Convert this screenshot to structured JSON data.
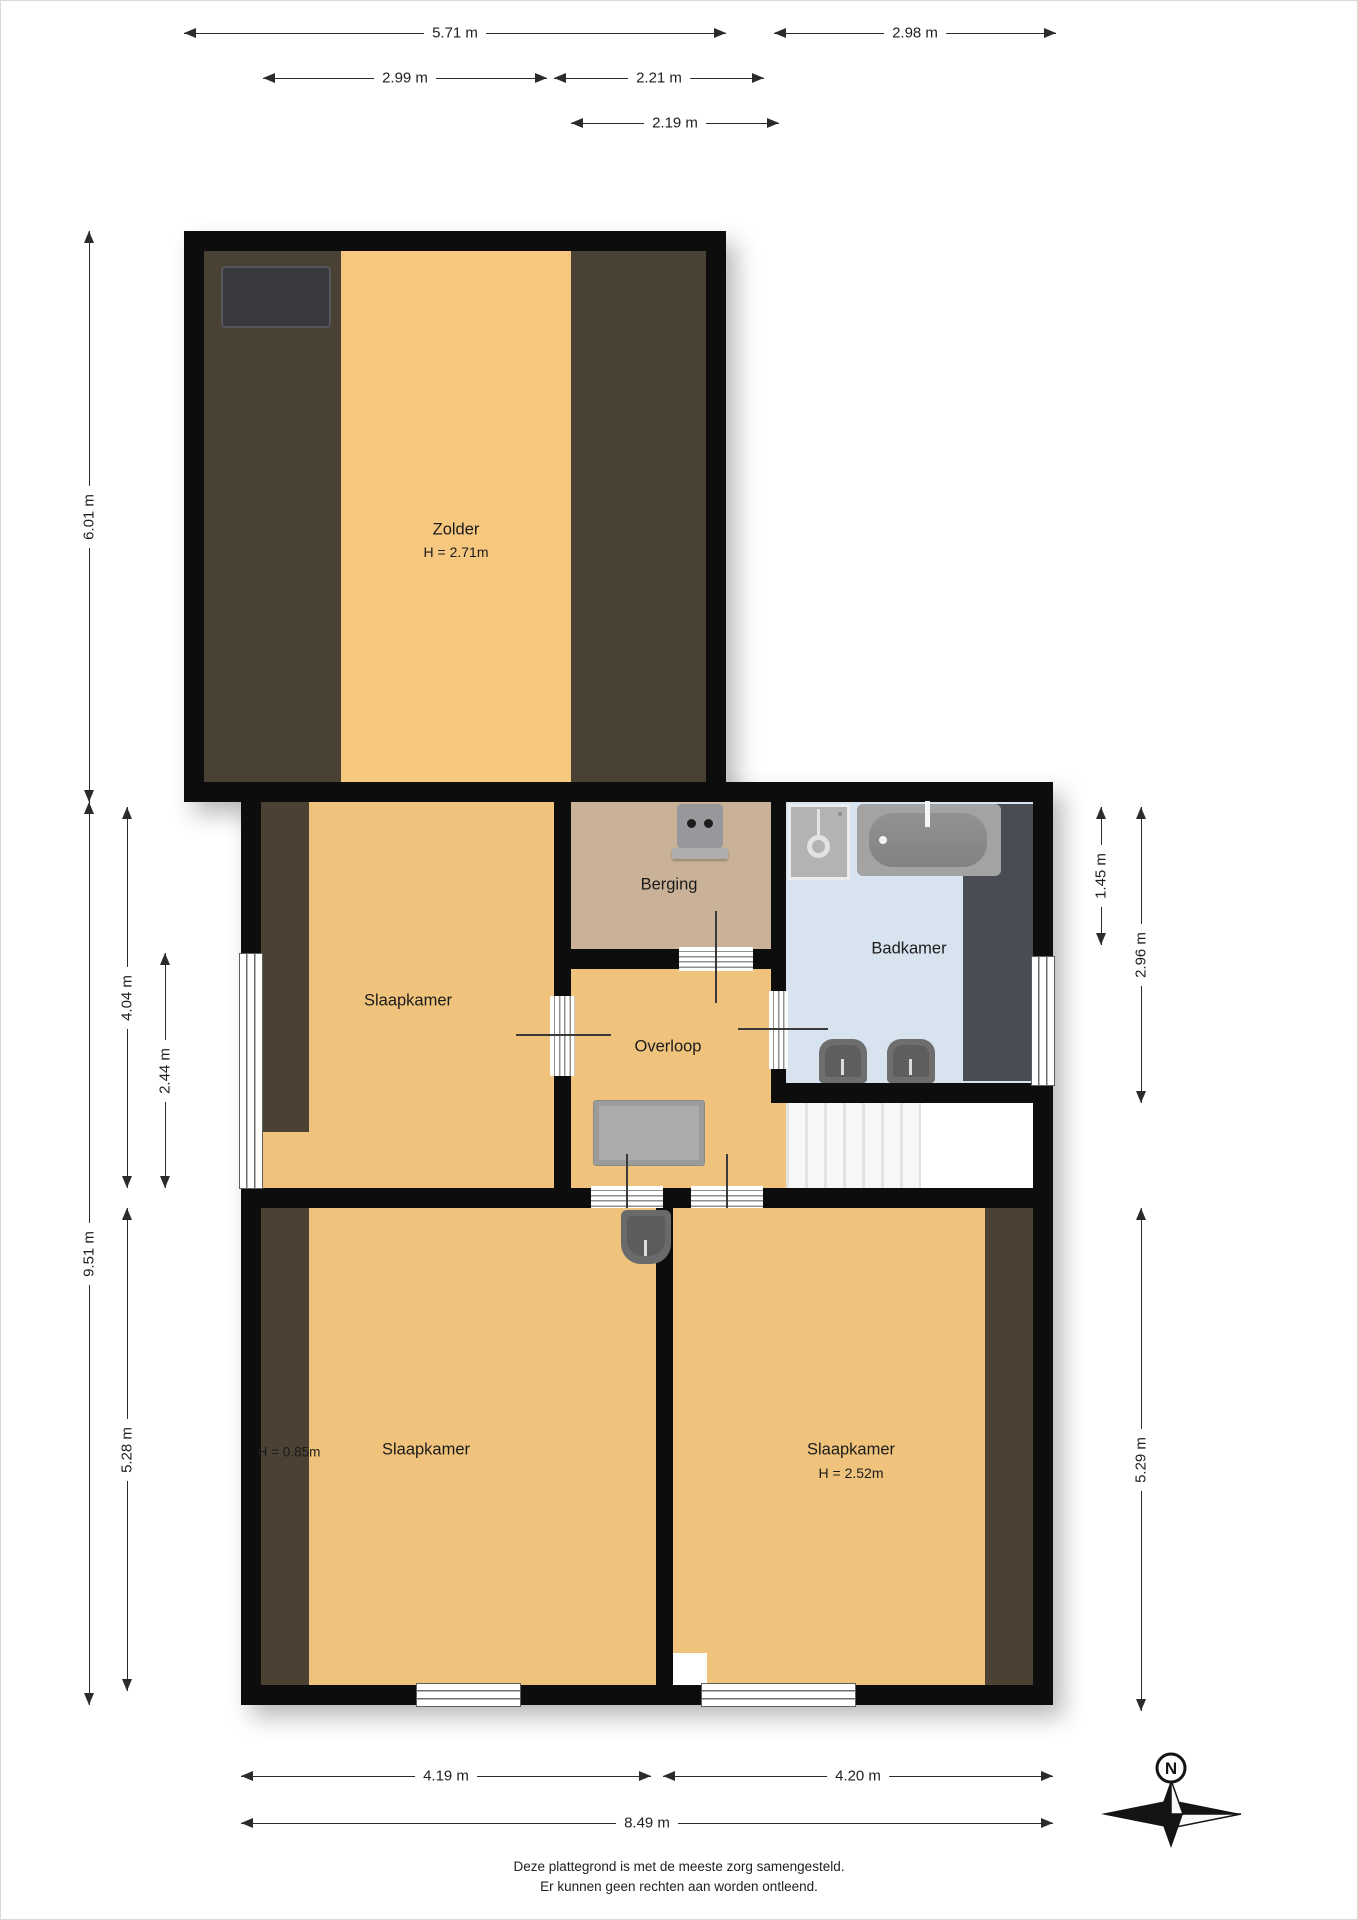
{
  "rooms": {
    "zolder": {
      "label": "Zolder",
      "height": "H = 2.71m"
    },
    "slaapkamer_middle": {
      "label": "Slaapkamer"
    },
    "berging": {
      "label": "Berging"
    },
    "overloop": {
      "label": "Overloop"
    },
    "badkamer": {
      "label": "Badkamer"
    },
    "slaapkamer_bottom_left": {
      "label": "Slaapkamer",
      "height": "H = 0.85m"
    },
    "slaapkamer_bottom_right": {
      "label": "Slaapkamer",
      "height": "H = 2.52m"
    }
  },
  "dimensions": {
    "top": [
      "5.71 m",
      "2.98 m",
      "2.99 m",
      "2.21 m",
      "2.19 m"
    ],
    "left": [
      "6.01 m",
      "9.51 m",
      "4.04 m",
      "2.44 m",
      "5.28 m"
    ],
    "right": [
      "1.45 m",
      "2.96 m",
      "5.29 m"
    ],
    "bottom": [
      "4.19 m",
      "4.20 m",
      "8.49 m"
    ]
  },
  "fixtures": {
    "skylight": "zolder roof window",
    "washer_outlet": "berging washing machine connection",
    "washbasin": "badkamer washbasin",
    "bathtub": "badkamer bathtub",
    "twin_sinks": "badkamer double sink",
    "bedroom_sink": "slaapkamer sink",
    "stairs": "staircase",
    "floor_hatch": "overloop hatch"
  },
  "colors": {
    "wall": "#0d0d0d",
    "floor_orange": "#f0c37c",
    "attic_strip_orange": "#f6c87f",
    "low_ceiling_brown": "#4a4135",
    "berging_tan": "#c9b297",
    "badkamer_blue": "#d8e3f0",
    "fixture_gray": "#a3a3a3"
  },
  "compass": {
    "north": "N"
  },
  "footer": {
    "line1": "Deze plattegrond is met de meeste zorg samengesteld.",
    "line2": "Er kunnen geen rechten aan worden ontleend."
  }
}
